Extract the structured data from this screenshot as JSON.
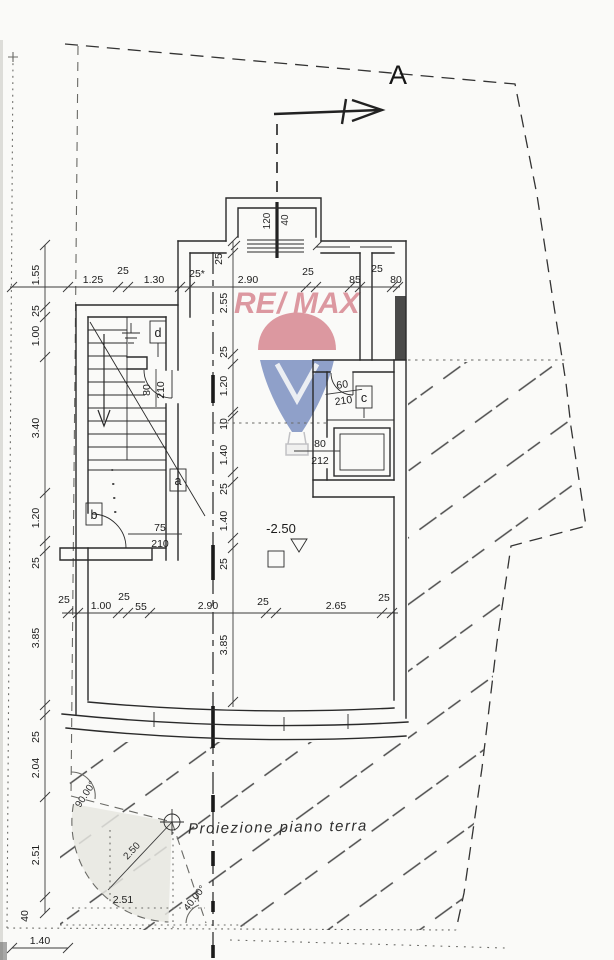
{
  "section": {
    "label": "A"
  },
  "note": {
    "projection": "Proiezione piano terra"
  },
  "level": {
    "value": "-2.50"
  },
  "watermark": {
    "re": "RE",
    "slash": "/",
    "max": "MAX"
  },
  "colors": {
    "remax_red": "#c0394b",
    "remax_blue": "#27489c"
  },
  "rooms": {
    "a": "a",
    "b": "b",
    "c": "c",
    "d": "d"
  },
  "bay": {
    "width": "120",
    "depth": "40"
  },
  "doors": {
    "stair": {
      "w": "80",
      "h": "210"
    },
    "room_b": {
      "w": "75",
      "h": "210"
    },
    "room_c": {
      "w": "60",
      "h": "210"
    },
    "shaft": {
      "w": "80",
      "h": "212"
    }
  },
  "survey": {
    "angle_nw": "90.00°",
    "angle_sw": "40.00°",
    "radius": "2.50",
    "chord": "2.51"
  },
  "dims": {
    "top": [
      "1.25",
      "25",
      "1.30",
      "25*",
      "2.90",
      "25",
      "85",
      "25",
      "80"
    ],
    "wall_top": "25",
    "center": [
      "2.55",
      "25",
      "1.20",
      "10",
      "1.40",
      "25",
      "1.40",
      "25",
      "3.85"
    ],
    "left": [
      "1.55",
      "25",
      "1.00",
      "3.40",
      "1.20",
      "25",
      "3.85",
      "25",
      "2.04",
      "2.51",
      "40"
    ],
    "left_bottom": "1.40",
    "bottom": [
      "25",
      "1.00",
      "25",
      "55",
      "2.90",
      "25",
      "2.65",
      "25"
    ]
  }
}
